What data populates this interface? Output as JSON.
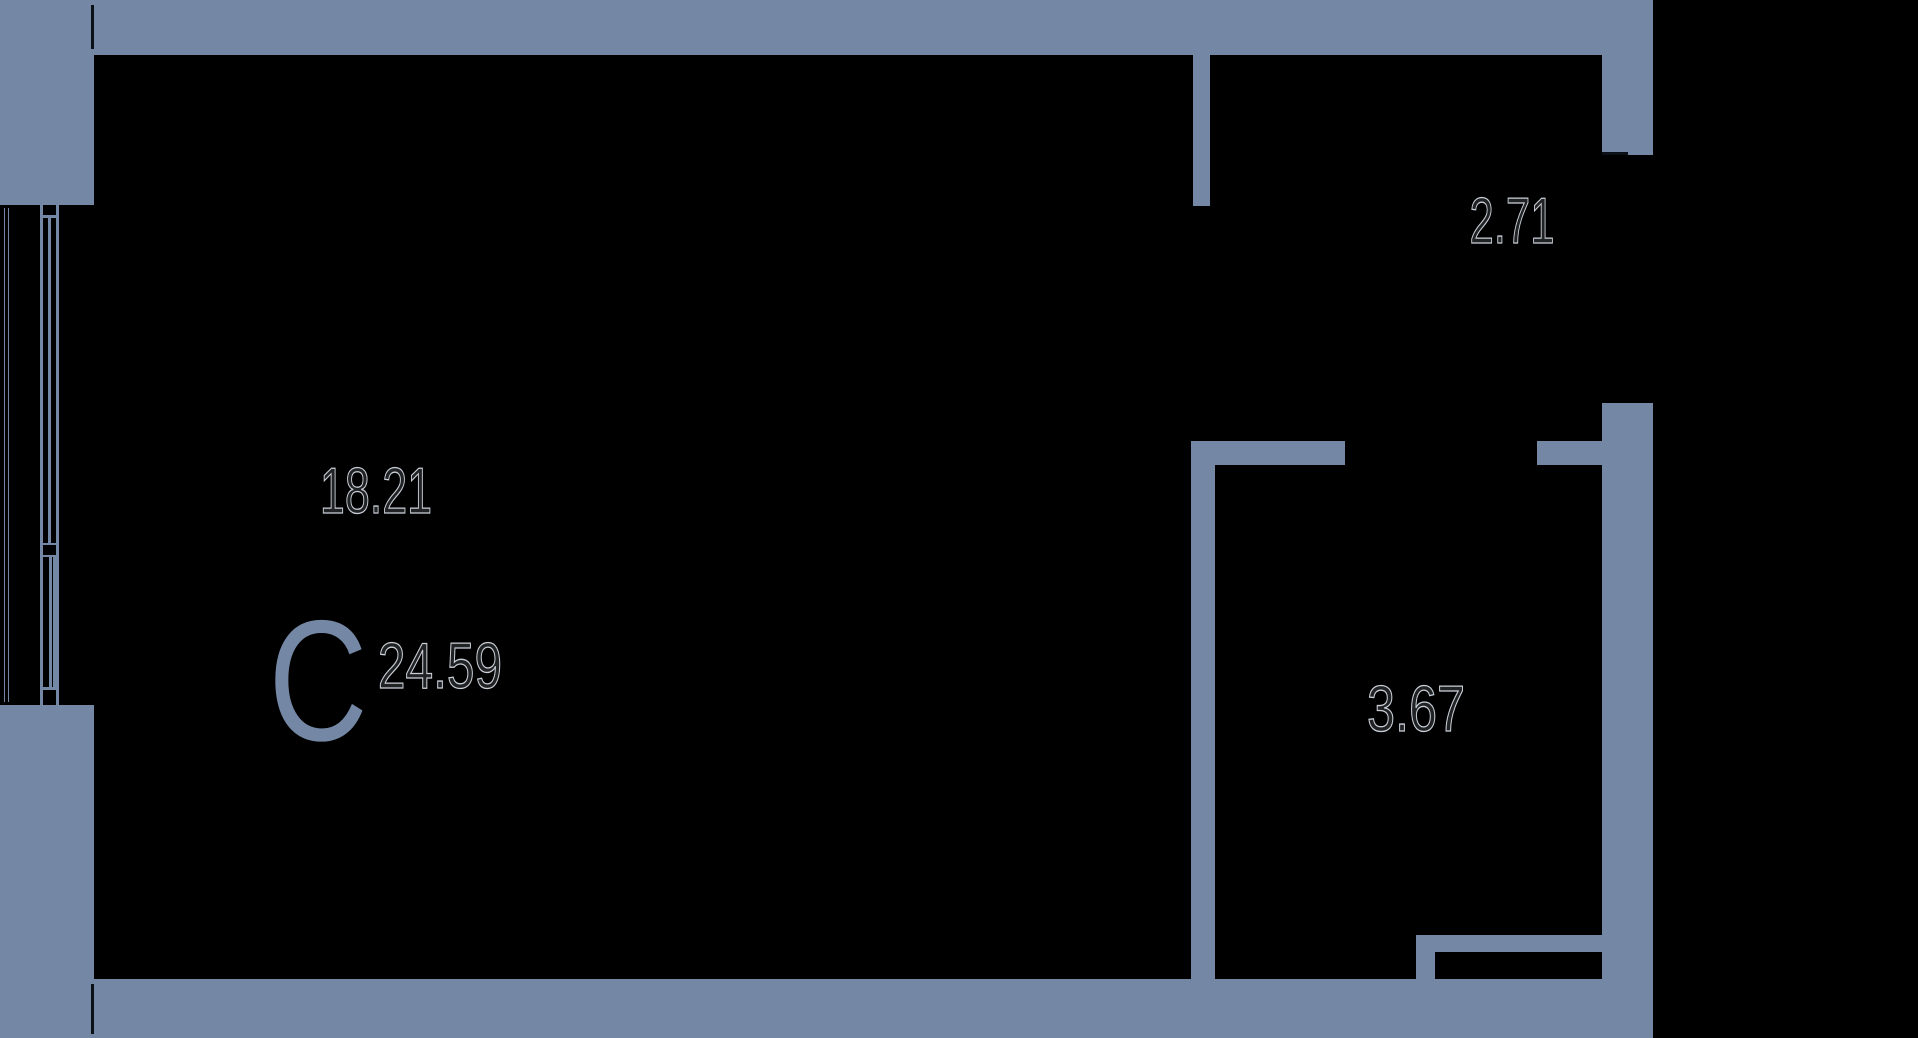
{
  "colors": {
    "background": "#000000",
    "wall": "#7488A6",
    "seam": "#0B1017",
    "outline": "#C9CFD8"
  },
  "compass": {
    "label": "С"
  },
  "rooms": [
    {
      "name": "main-room",
      "area": "18.21"
    },
    {
      "name": "total-area",
      "area": "24.59"
    },
    {
      "name": "loggia",
      "area": "2.71"
    },
    {
      "name": "bathroom",
      "area": "3.67"
    }
  ]
}
